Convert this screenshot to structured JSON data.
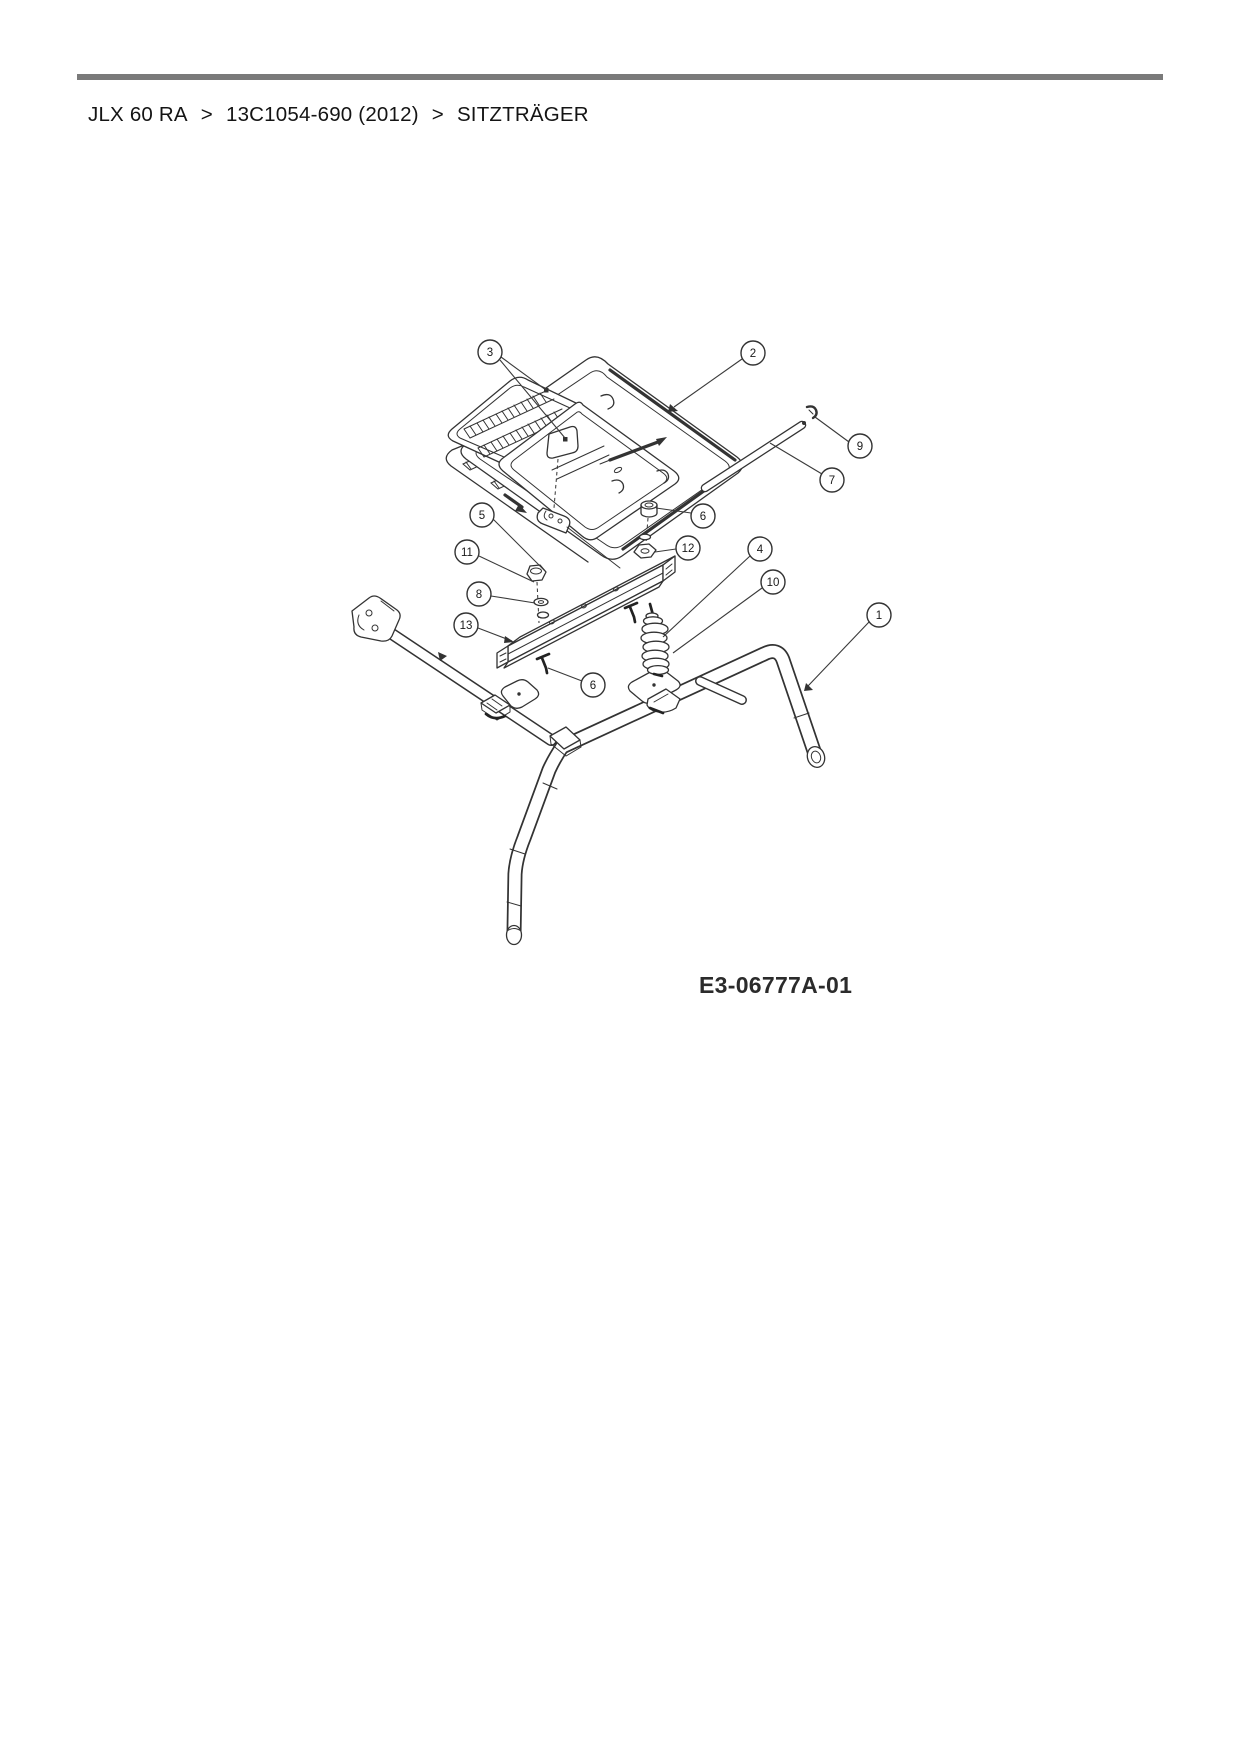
{
  "breadcrumb": {
    "model": "JLX 60 RA",
    "separator1": ">",
    "part_number": "13C1054-690 (2012)",
    "separator2": ">",
    "section": "SITZTRÄGER"
  },
  "diagram": {
    "code": "E3-06777A-01",
    "callouts": [
      {
        "label": "1"
      },
      {
        "label": "2"
      },
      {
        "label": "3"
      },
      {
        "label": "4"
      },
      {
        "label": "5"
      },
      {
        "label": "6"
      },
      {
        "label": "6"
      },
      {
        "label": "7"
      },
      {
        "label": "8"
      },
      {
        "label": "9"
      },
      {
        "label": "10"
      },
      {
        "label": "11"
      },
      {
        "label": "12"
      },
      {
        "label": "13"
      }
    ]
  },
  "colors": {
    "line": "#333333",
    "rule": "#7a7a7a",
    "background": "#ffffff"
  }
}
